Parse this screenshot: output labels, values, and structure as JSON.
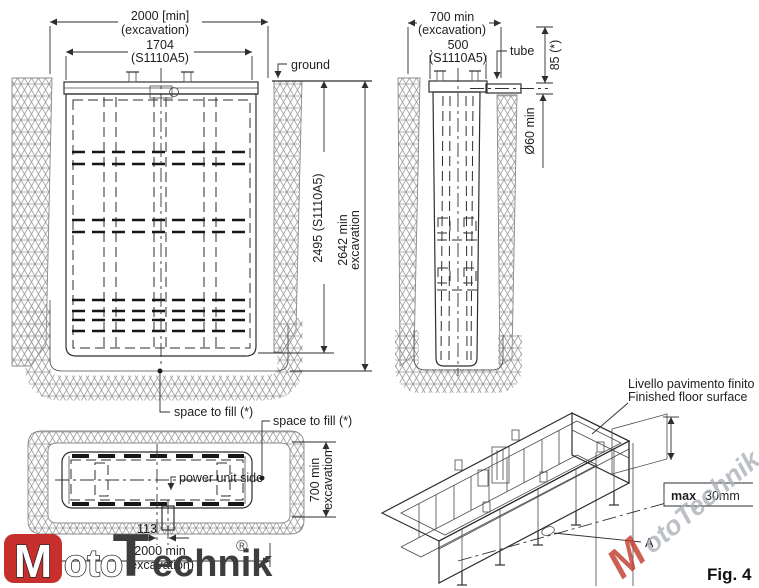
{
  "figure": {
    "label": "Fig. 4"
  },
  "front_view": {
    "dim_excavation_width_value": "2000 [min]",
    "dim_excavation_width_note": "(excavation)",
    "dim_unit_width_value": "1704",
    "dim_unit_width_note": "(S1110A5)",
    "ground_label": "ground",
    "dim_unit_depth": "2495 (S1110A5)",
    "dim_excavation_depth_value": "2642 min",
    "dim_excavation_depth_note": "excavation",
    "space_to_fill_label": "space to fill (*)"
  },
  "side_view": {
    "dim_excavation_width_value": "700 min",
    "dim_excavation_width_note": "(excavation)",
    "dim_unit_width_value": "500",
    "dim_unit_width_note": "(S1110A5)",
    "tube_label": "tube",
    "dim_tube_height": "85 (*)",
    "dim_tube_diameter": "Ø60 min"
  },
  "plan_view": {
    "power_unit_label": "power unit side",
    "space_to_fill_label": "space to fill (*)",
    "dim_excavation_depth_value": "700 min",
    "dim_excavation_depth_note": "excavation",
    "dim_tube_offset": "113",
    "dim_excavation_width_value": "2000 min",
    "dim_excavation_width_note": "(excavation)"
  },
  "isometric_view": {
    "floor_level_label_it": "Livello pavimento finito",
    "floor_level_label_en": "Finished floor surface",
    "dim_floor_max_bold": "max",
    "dim_floor_max_value": "30mm",
    "point_label": "A"
  },
  "logo": {
    "m": "M",
    "oto": "oto",
    "t": "T",
    "echnik": "echnik",
    "registered": "®"
  },
  "watermark": {
    "initial": "M",
    "text": "otoTechnik.pl"
  },
  "colors": {
    "line": "#2e2e2e",
    "hatch": "#9a9a9a",
    "logo_red": "#c62f2c",
    "watermark_gray": "#adb2b8"
  }
}
